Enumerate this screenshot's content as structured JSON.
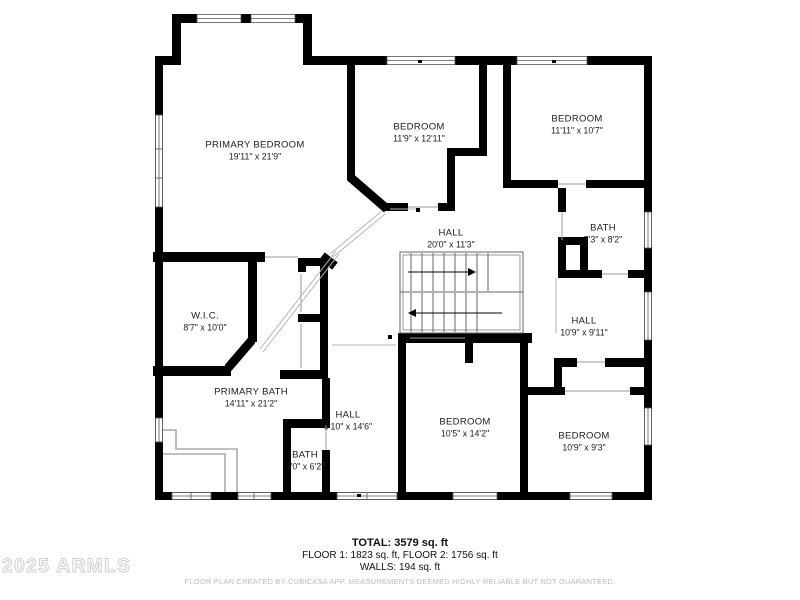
{
  "rooms": [
    {
      "id": "primary-bedroom",
      "name": "PRIMARY BEDROOM",
      "dims": "19'11\" x 21'9\""
    },
    {
      "id": "bedroom-top-center",
      "name": "BEDROOM",
      "dims": "11'9\" x 12'11\""
    },
    {
      "id": "bedroom-top-right",
      "name": "BEDROOM",
      "dims": "11'11\" x 10'7\""
    },
    {
      "id": "bath-right",
      "name": "BATH",
      "dims": "7'3\" x 8'2\""
    },
    {
      "id": "hall-center",
      "name": "HALL",
      "dims": "20'0\" x 11'3\""
    },
    {
      "id": "wic",
      "name": "W.I.C.",
      "dims": "8'7\" x 10'0\""
    },
    {
      "id": "hall-right",
      "name": "HALL",
      "dims": "10'9\" x 9'11\""
    },
    {
      "id": "primary-bath",
      "name": "PRIMARY BATH",
      "dims": "14'11\" x 21'2\""
    },
    {
      "id": "hall-bottom",
      "name": "HALL",
      "dims": "6'10\" x 14'6\""
    },
    {
      "id": "bath-bottom",
      "name": "BATH",
      "dims": "3'0\" x 6'2\""
    },
    {
      "id": "bedroom-bottom-center",
      "name": "BEDROOM",
      "dims": "10'5\" x 14'2\""
    },
    {
      "id": "bedroom-bottom-right",
      "name": "BEDROOM",
      "dims": "10'9\" x 9'3\""
    }
  ],
  "footer": {
    "total": "TOTAL: 3579 sq. ft",
    "floors": "FLOOR 1: 1823 sq. ft, FLOOR 2: 1756 sq. ft",
    "walls": "WALLS: 194 sq. ft",
    "disclaimer": "FLOOR PLAN CREATED BY CUBICASA APP. MEASUREMENTS DEEMED HIGHLY RELIABLE BUT NOT GUARANTEED."
  },
  "watermark": "2025 ARMLS",
  "colors": {
    "wall": "#000000",
    "fixture_outline": "#9a9a9a",
    "separator": "#aaaaaa",
    "watermark": "#d4d4d4",
    "disclaimer": "#bdbdbd"
  }
}
